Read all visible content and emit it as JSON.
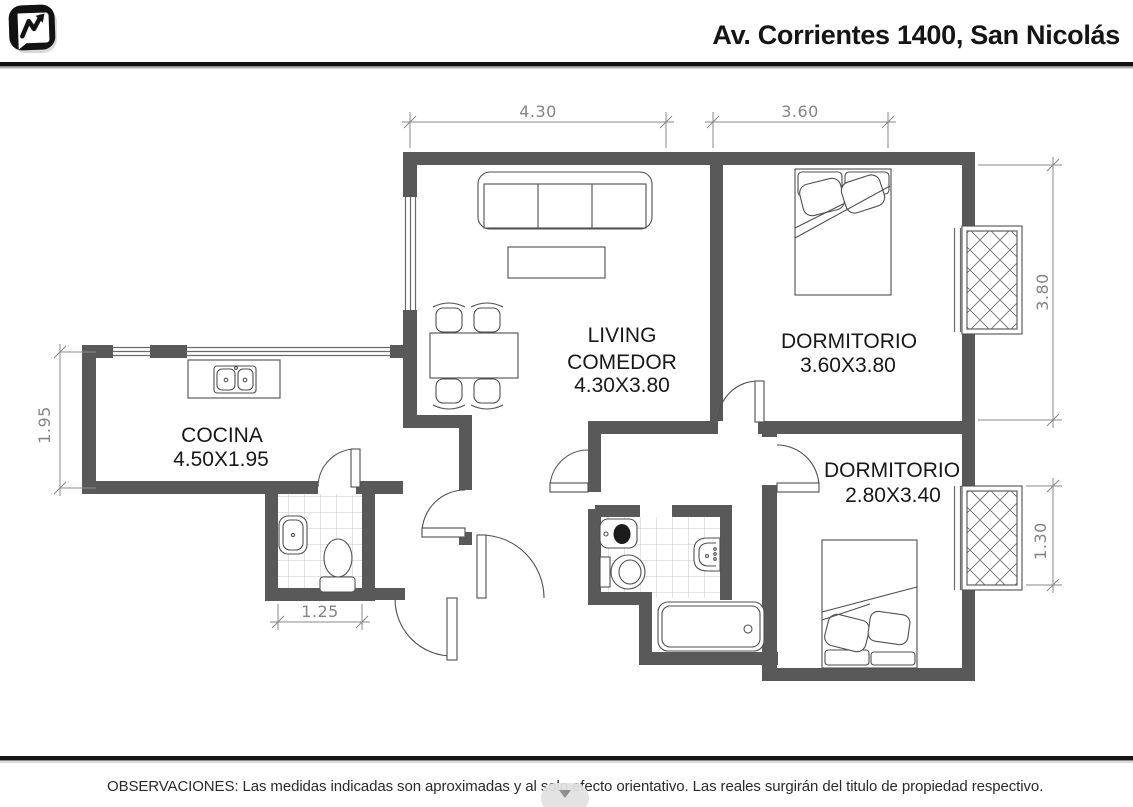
{
  "header": {
    "title": "Av. Corrientes 1400, San Nicolás"
  },
  "plan": {
    "labels": {
      "living": {
        "line1": "LIVING",
        "line2": "COMEDOR",
        "line3": "4.30X3.80"
      },
      "dormitorio1": {
        "line1": "DORMITORIO",
        "line2": "3.60X3.80"
      },
      "dormitorio2": {
        "line1": "DORMITORIO",
        "line2": "2.80X3.40"
      },
      "cocina": {
        "line1": "COCINA",
        "line2": "4.50X1.95"
      }
    },
    "dimensions": {
      "top_left": "4.30",
      "top_right": "3.60",
      "right_upper": "3.80",
      "right_lower": "1.30",
      "left": "1.95",
      "bottom": "1.25"
    },
    "colors": {
      "wall": "#595959",
      "dimension": "#848484",
      "label": "#181818"
    }
  },
  "footer": {
    "note": "OBSERVACIONES: Las medidas indicadas son aproximadas y al solo efecto orientativo. Las reales surgirán del titulo de propiedad respectivo."
  }
}
